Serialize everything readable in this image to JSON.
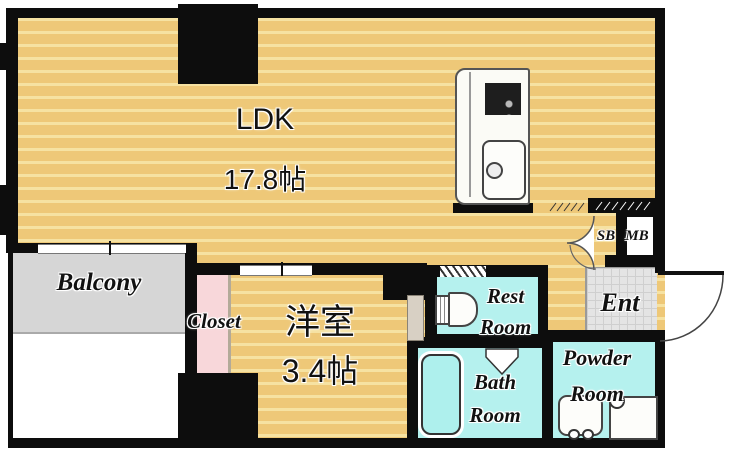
{
  "plan": {
    "title": "apartment-floor-plan",
    "rooms": {
      "ldk": {
        "name": "LDK",
        "size": "17.8帖"
      },
      "western_room": {
        "name": "洋室",
        "size": "3.4帖"
      },
      "balcony": {
        "name": "Balcony"
      },
      "closet": {
        "name": "Closet"
      },
      "rest_room": {
        "line1": "Rest",
        "line2": "Room"
      },
      "bath_room": {
        "line1": "Bath",
        "line2": "Room"
      },
      "powder_room": {
        "line1": "Powder",
        "line2": "Room"
      },
      "entrance": {
        "name": "Ent"
      },
      "shoe_box": {
        "name": "SB"
      },
      "meter_box": {
        "name": "MB"
      }
    },
    "fixtures": [
      "kitchen-stove",
      "kitchen-sink",
      "toilet",
      "bathtub",
      "washbasin",
      "washing-machine-pan",
      "entrance-door-swing",
      "shoe-box-folding-door"
    ],
    "colors": {
      "floor_tan": "#eec878",
      "floor_stripe": "#f6e2a2",
      "wet_area_cyan": "#b5f1ee",
      "closet_pink": "#f8d7da",
      "balcony_gray": "#d6d6d6",
      "entry_tile_gray": "#e4e4e4",
      "wall_black": "#0d0d0d",
      "bathtub_fill": "#aef0ed"
    }
  }
}
